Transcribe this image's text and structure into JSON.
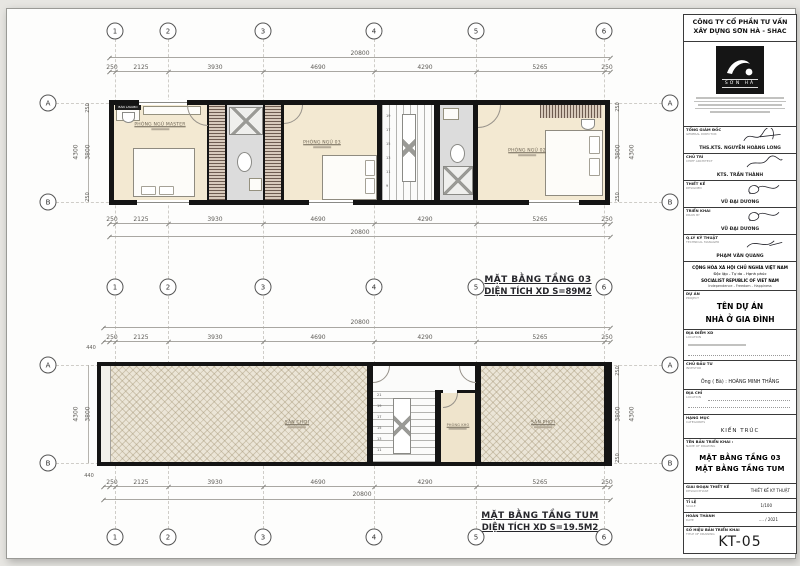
{
  "grid": {
    "cols": [
      "1",
      "2",
      "3",
      "4",
      "5",
      "6"
    ],
    "rows": [
      "A",
      "B"
    ]
  },
  "plan_top": {
    "title": "MẶT BẰNG TẦNG 03",
    "subtitle": "DIỆN TÍCH XD S=89M2",
    "total": "20800",
    "dims": [
      "250",
      "2125",
      "3930",
      "4690",
      "4290",
      "5265",
      "250"
    ],
    "side": {
      "overall": "4300",
      "inner": "3800",
      "edge": "250"
    },
    "rooms": {
      "master": "PHÒNG NGỦ MASTER",
      "bed3": "PHÒNG NGỦ 03",
      "bed2": "PHÒNG NGỦ 02",
      "lavabo_tag": "BÀN LAVABO"
    },
    "stairs": [
      "19",
      "17",
      "15",
      "13",
      "11",
      "9"
    ]
  },
  "plan_tum": {
    "title": "MẶT BẰNG TẦNG TUM",
    "subtitle": "DIỆN TÍCH XD S=19.5M2",
    "total": "20800",
    "offset": "440",
    "dims": [
      "250",
      "2125",
      "3930",
      "4690",
      "4290",
      "5265",
      "250"
    ],
    "side": {
      "overall": "4300",
      "inner": "3800",
      "edge": "250"
    },
    "rooms": {
      "left_terrace": "SÂN CHƠI",
      "storage": "PHÒNG KHO",
      "right_terrace": "SÂN PHƠI"
    },
    "stairs": [
      "21",
      "19",
      "17",
      "15",
      "13",
      "11"
    ]
  },
  "title_block": {
    "company_line1": "CÔNG TY CỔ PHẦN TƯ VẤN",
    "company_line2": "XÂY DỰNG SƠN HÀ - SHAC",
    "logo_text": "SƠN HÀ",
    "signers": [
      {
        "role": "TỔNG GIÁM ĐỐC",
        "role_en": "GENERAL DIRECTOR",
        "name": "THS.KTS. NGUYỄN HOÀNG LONG"
      },
      {
        "role": "CHỦ TRÌ",
        "role_en": "CHIEF ARCHITECT",
        "name": "KTS. TRẦN THÀNH"
      },
      {
        "role": "THIẾT KẾ",
        "role_en": "DESIGNED",
        "name": "VŨ ĐẠI DƯƠNG"
      },
      {
        "role": "TRIỂN KHAI",
        "role_en": "DRAW BY",
        "name": "VŨ ĐẠI DƯƠNG"
      },
      {
        "role": "Q.LÝ KỸ THUẬT",
        "role_en": "TECHNICAL MANAGER",
        "name": "PHẠM VĂN QUANG"
      }
    ],
    "republic": {
      "line1": "CỘNG HÒA XÃ HỘI CHỦ NGHĨA VIỆT NAM",
      "line2": "Độc lập - Tự do - Hạnh phúc",
      "line3": "SOCIALIST REPUBLIC OF VIET NAM",
      "line4": "Independence - Freedom - Happiness"
    },
    "project": {
      "label": "DỰ ÁN",
      "label_en": "PROJECT",
      "name_line1": "TÊN DỰ ÁN",
      "name_line2": "NHÀ Ở GIA ĐÌNH"
    },
    "site": {
      "label": "ĐỊA ĐIỂM XD",
      "label_en": "LOCATION"
    },
    "investor": {
      "label": "CHỦ ĐẦU TƯ",
      "label_en": "INVESTOR",
      "value": "Ông ( Bà) : HOÀNG MINH THẮNG"
    },
    "address": {
      "label": "ĐỊA CHỈ",
      "label_en": "LOCATION"
    },
    "category": {
      "label": "HẠNG MỤC",
      "label_en": "CATEGORIES",
      "value": "KIẾN TRÚC"
    },
    "drawing_name": {
      "label": "TÊN BẢN TRIỂN KHAI :",
      "label_en": "NAME OF DRAWING",
      "line1": "MẶT BẰNG TẦNG 03",
      "line2": "MẶT BẰNG TẦNG TUM"
    },
    "phase": {
      "label": "GIAI ĐOẠN THIẾT KẾ",
      "label_en": "DESIGN PHASE",
      "value": "THIẾT KẾ KỸ THUẬT"
    },
    "scale": {
      "label": "TỈ LỆ",
      "label_en": "SCALE",
      "value": "1/100"
    },
    "date": {
      "label": "HOÀN THÀNH",
      "label_en": "DATE",
      "value": ".... / 2021"
    },
    "number": {
      "label": "SỐ HIỆU BẢN TRIỂN KHAI",
      "label_en": "TITLE OF DRAWING",
      "value": "KT-05"
    }
  }
}
